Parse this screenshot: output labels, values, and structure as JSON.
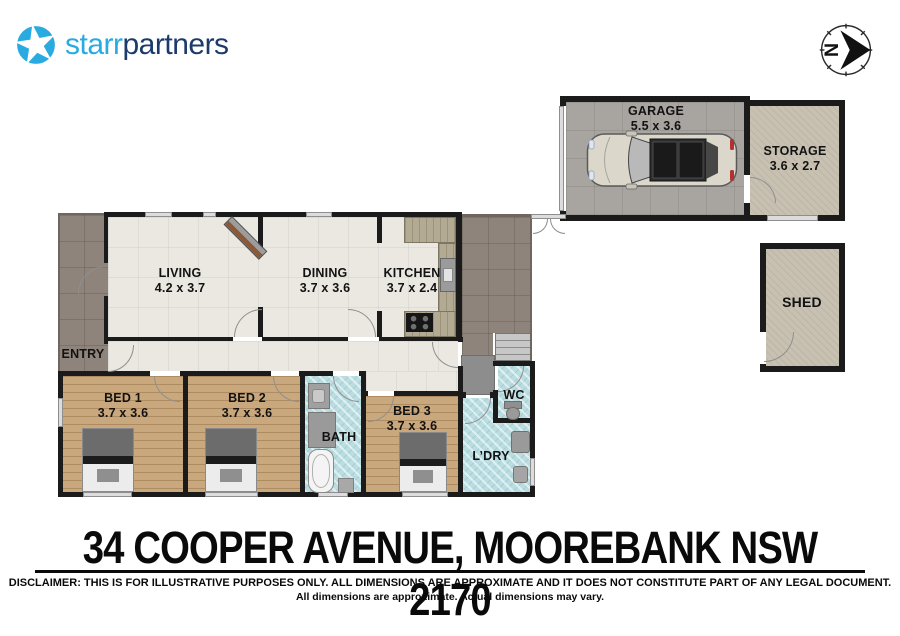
{
  "header": {
    "logo": {
      "text_primary": "starr",
      "text_secondary": "partners",
      "icon": "star-in-circle",
      "color_primary": "#29abe2",
      "color_secondary": "#1c3a6b"
    },
    "compass": {
      "label": "N",
      "direction": "right"
    }
  },
  "rooms": {
    "garage": {
      "label": "GARAGE",
      "dims": "5.5 x 3.6"
    },
    "storage": {
      "label": "STORAGE",
      "dims": "3.6 x 2.7"
    },
    "shed": {
      "label": "SHED"
    },
    "living": {
      "label": "LIVING",
      "dims": "4.2 x 3.7"
    },
    "dining": {
      "label": "DINING",
      "dims": "3.7 x 3.6"
    },
    "kitchen": {
      "label": "KITCHEN",
      "dims": "3.7 x 2.4"
    },
    "entry": {
      "label": "ENTRY"
    },
    "bed1": {
      "label": "BED 1",
      "dims": "3.7 x 3.6"
    },
    "bed2": {
      "label": "BED 2",
      "dims": "3.7 x 3.6"
    },
    "bed3": {
      "label": "BED 3",
      "dims": "3.7 x 3.6"
    },
    "bath": {
      "label": "BATH"
    },
    "wc": {
      "label": "WC"
    },
    "ldry": {
      "label": "L’DRY"
    }
  },
  "footer": {
    "address": "34 COOPER AVENUE, MOOREBANK NSW 2170",
    "disclaimer_line1": "DISCLAIMER: THIS IS FOR ILLUSTRATIVE PURPOSES ONLY. ALL DIMENSIONS ARE APPROXIMATE AND IT DOES NOT CONSTITUTE PART OF ANY LEGAL DOCUMENT.",
    "disclaimer_line2": "All dimensions are approximate. Actual dimensions may vary."
  },
  "colors": {
    "wall": "#1b1b1b",
    "floor_interior": "#eae8e1",
    "floor_porch": "#8e847b",
    "floor_bedroom_wood": "#c9a87d",
    "floor_wet_blue": "#b9dde1",
    "floor_garage": "#a8a4a0",
    "floor_storage": "#c8c1b2",
    "brand_blue": "#29abe2",
    "brand_navy": "#1c3a6b"
  }
}
